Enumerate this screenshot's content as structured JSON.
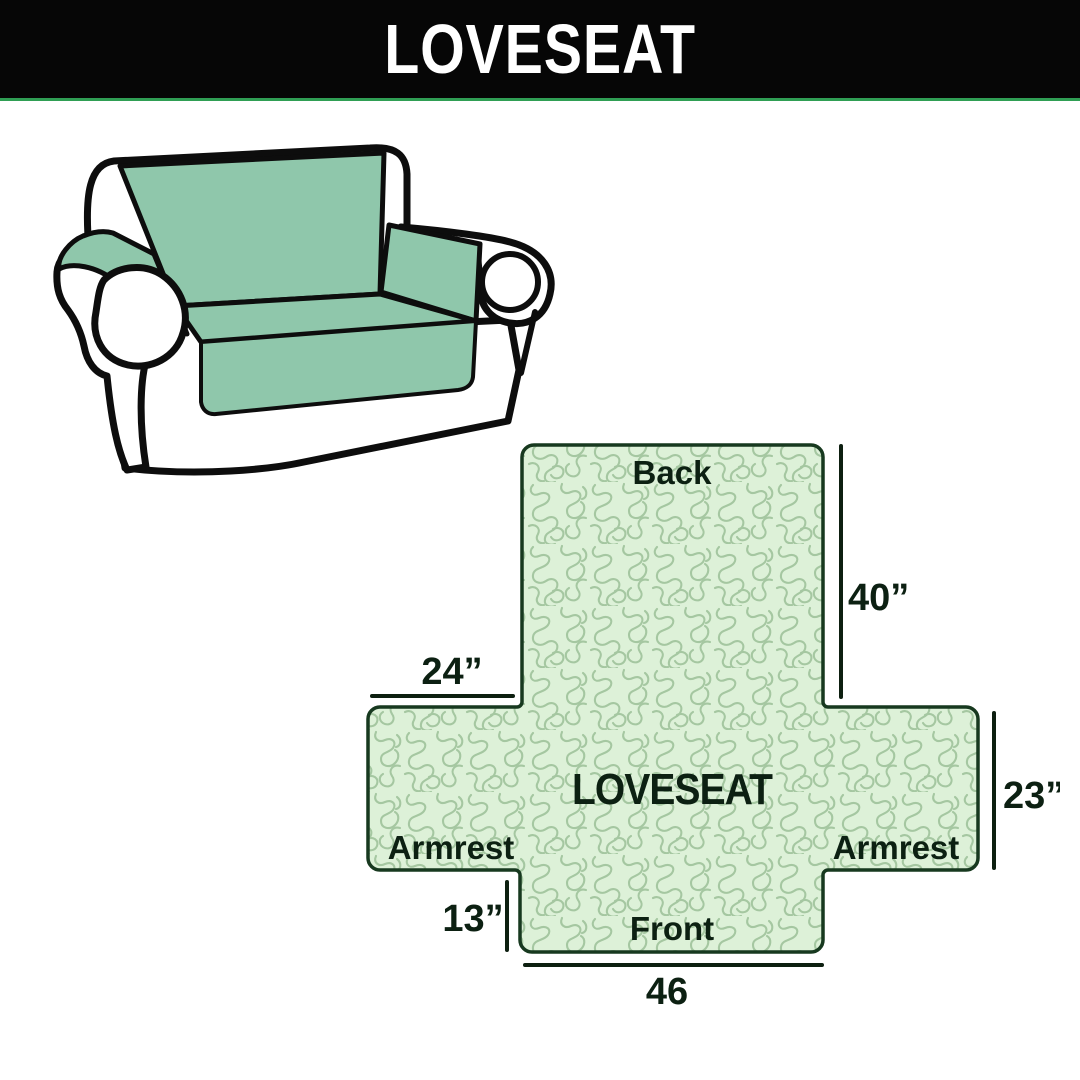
{
  "header": {
    "title": "LOVESEAT",
    "bg_color": "#060606",
    "text_color": "#ffffff",
    "divider_color": "#2f9e54"
  },
  "sofa_illustration": {
    "description": "loveseat sofa with mint-green slipcover on back, seat and armrest tops",
    "cover_color": "#8fc7ab",
    "body_color": "#ffffff",
    "outline_color": "#0d0d0d"
  },
  "diagram": {
    "center_label": "LOVESEAT",
    "labels": {
      "back": "Back",
      "front": "Front",
      "armrest_left": "Armrest",
      "armrest_right": "Armrest"
    },
    "measurements": {
      "back_height": "40”",
      "armrest_top_width": "24”",
      "side_height": "23”",
      "front_drop": "13”",
      "front_width": "46"
    },
    "colors": {
      "fill": "#ddf1d8",
      "pattern_line": "#a5c7a1",
      "outline": "#17391f",
      "text": "#0c2012",
      "dimension_line": "#0d1f10"
    }
  }
}
